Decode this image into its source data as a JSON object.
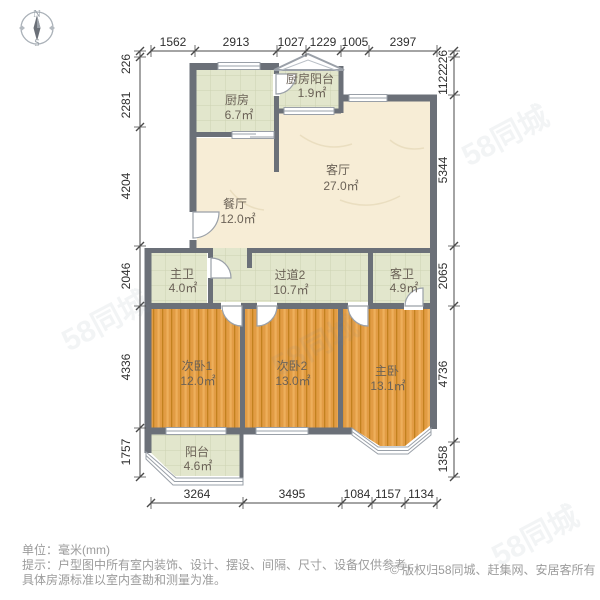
{
  "compass": {
    "north": "N",
    "south": "S"
  },
  "watermark": {
    "text": "58同城"
  },
  "rooms": {
    "kitchen": {
      "name": "厨房",
      "area": "6.7㎡"
    },
    "kitchen_balcony": {
      "name": "厨房阳台",
      "area": "1.9㎡"
    },
    "living": {
      "name": "客厅",
      "area": "27.0㎡"
    },
    "dining": {
      "name": "餐厅",
      "area": "12.0㎡"
    },
    "master_bath": {
      "name": "主卫",
      "area": "4.0㎡"
    },
    "hallway": {
      "name": "过道2",
      "area": "10.7㎡"
    },
    "guest_bath": {
      "name": "客卫",
      "area": "4.9㎡"
    },
    "bedroom_2_1": {
      "name": "次卧1",
      "area": "12.0㎡"
    },
    "bedroom_2_2": {
      "name": "次卧2",
      "area": "13.0㎡"
    },
    "master_bedroom": {
      "name": "主卧",
      "area": "13.1㎡"
    },
    "balcony": {
      "name": "阳台",
      "area": "4.6㎡"
    }
  },
  "dimensions": {
    "top": [
      "1562",
      "2913",
      "1027",
      "1229",
      "1005",
      "2397"
    ],
    "bottom": [
      "3264",
      "3495",
      "1084",
      "1157",
      "1134"
    ],
    "left": [
      "226",
      "2281",
      "4204",
      "2046",
      "4336",
      "1757"
    ],
    "right": [
      "226",
      "1122",
      "5344",
      "2065",
      "4736",
      "1358"
    ]
  },
  "footer": {
    "unit": "单位：毫米(mm)",
    "tip_line1": "提示：户型图中所有室内装饰、设计、摆设、间隔、尺寸、设备仅供参考，",
    "tip_line2": "具体房源标准以室内查勘和测量为准。",
    "copyright": "© 版权归58同城、赶集网、安居客所有"
  },
  "colors": {
    "wall": "#6b7078",
    "wood_floor": "#e29c44",
    "tile_floor": "#e2e6cc",
    "marble_floor": "#f7edd6",
    "dimension_text": "#2f2f2f",
    "footer_text": "#9b9b9b"
  }
}
